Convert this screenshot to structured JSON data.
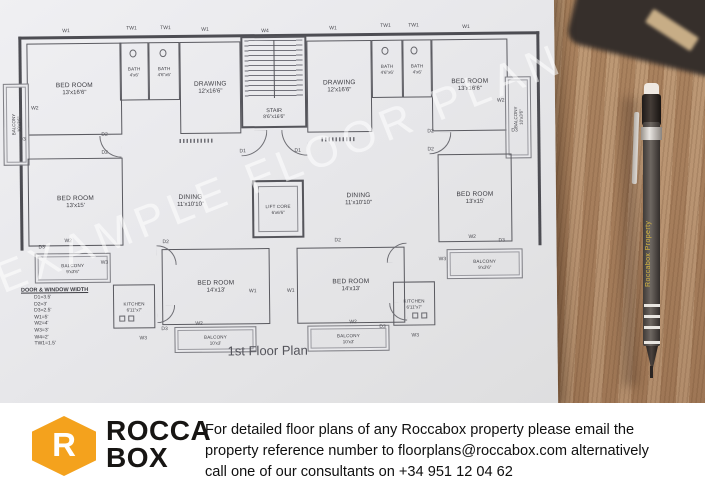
{
  "plan": {
    "title": "1st Floor Plan",
    "watermark": "EXAMPLE FLOOR PLAN",
    "rooms": {
      "bedroom_tl": {
        "name": "BED ROOM",
        "dims": "13'x16'6\""
      },
      "bath_l1": {
        "name": "BATH",
        "dims": "4'x6'"
      },
      "bath_l2": {
        "name": "BATH",
        "dims": "4'6\"x6'"
      },
      "drawing_l": {
        "name": "DRAWING",
        "dims": "12'x16'6\""
      },
      "stair": {
        "name": "STAIR",
        "dims": "8'6\"x16'6\""
      },
      "drawing_r": {
        "name": "DRAWING",
        "dims": "12'x16'6\""
      },
      "bath_r1": {
        "name": "BATH",
        "dims": "4'6\"x6'"
      },
      "bath_r2": {
        "name": "BATH",
        "dims": "4'x6'"
      },
      "bedroom_tr": {
        "name": "BED ROOM",
        "dims": "13'x16'6\""
      },
      "balcony_tl": {
        "name": "BALCONY",
        "dims": "10'x3'6\""
      },
      "balcony_tr": {
        "name": "BALCONY",
        "dims": "10'x3'6\""
      },
      "bedroom_ml": {
        "name": "BED ROOM",
        "dims": "13'x15'"
      },
      "dining_l": {
        "name": "DINING",
        "dims": "11'x10'10\""
      },
      "lift": {
        "name": "LIFT CORE",
        "dims": "6'x6'6\""
      },
      "dining_r": {
        "name": "DINING",
        "dims": "11'x10'10\""
      },
      "bedroom_mr": {
        "name": "BED ROOM",
        "dims": "13'x15'"
      },
      "balcony_ml": {
        "name": "BALCONY",
        "dims": "9'x3'6\""
      },
      "balcony_mr": {
        "name": "BALCONY",
        "dims": "9'x3'6\""
      },
      "kitchen_l": {
        "name": "KITCHEN",
        "dims": "6'11\"x7'"
      },
      "bedroom_bl": {
        "name": "BED ROOM",
        "dims": "14'x13'"
      },
      "bedroom_br": {
        "name": "BED ROOM",
        "dims": "14'x13'"
      },
      "kitchen_r": {
        "name": "KITCHEN",
        "dims": "6'11\"x7'"
      },
      "balcony_bl": {
        "name": "BALCONY",
        "dims": "10'x3'"
      },
      "balcony_br": {
        "name": "BALCONY",
        "dims": "10'x3'"
      }
    },
    "legend": {
      "title": "DOOR & WINDOW WIDTH",
      "entries": [
        "D1=3.5'",
        "D2=3'",
        "D3=2.5'",
        "W1=5'",
        "W2=4'",
        "W3=3'",
        "W4=2'",
        "TW1=1.5'"
      ]
    },
    "markers": [
      "W1",
      "TW1",
      "TW1",
      "W1",
      "W4",
      "W1",
      "TW1",
      "TW1",
      "W1",
      "W2",
      "D3",
      "W2",
      "D3",
      "D2",
      "D2",
      "D1",
      "D1",
      "D2",
      "D2",
      "D3",
      "W2",
      "W3",
      "W2",
      "W3",
      "D3",
      "D2",
      "D2",
      "W1",
      "W1",
      "W2",
      "D3",
      "W2",
      "D3",
      "W3",
      "W3"
    ]
  },
  "pencil": {
    "brand": "Roccabox Property"
  },
  "footer": {
    "brand_color": "#F4A21D",
    "logo_letter": "R",
    "logo_word1": "ROCCA",
    "logo_word2": "BOX",
    "line1": "For detailed floor plans of any Roccabox property please email the",
    "line2": "property reference number to floorplans@roccabox.com alternatively",
    "line3": "call one of our consultants on +34 951 12 04 62"
  }
}
